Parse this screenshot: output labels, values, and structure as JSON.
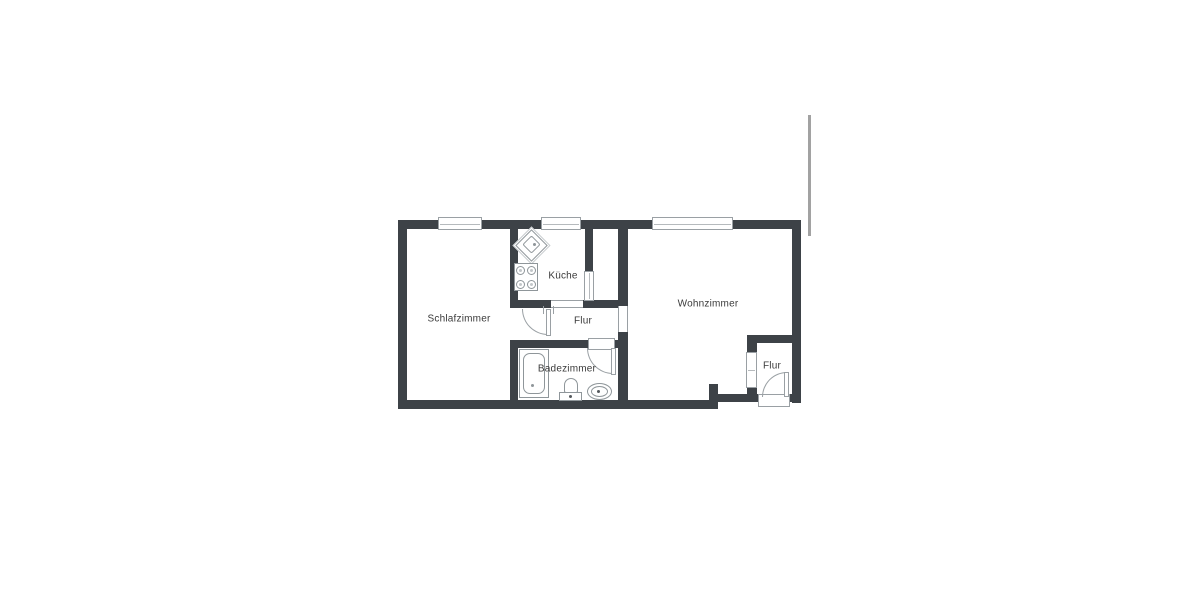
{
  "floorplan": {
    "type": "apartment-floor-plan",
    "wall_color": "#3d4247",
    "symbol_line_color": "#9aa0a4",
    "background_color": "#ffffff",
    "rooms": [
      {
        "id": "schlafzimmer",
        "label": "Schlafzimmer"
      },
      {
        "id": "kueche",
        "label": "Küche"
      },
      {
        "id": "flur",
        "label": "Flur"
      },
      {
        "id": "wohnzimmer",
        "label": "Wohnzimmer"
      },
      {
        "id": "badezimmer",
        "label": "Badezimmer"
      },
      {
        "id": "flur-eingang",
        "label": "Flur"
      }
    ],
    "fixtures": [
      "kitchen-corner-sink",
      "stove-4-burners",
      "bathtub",
      "washbasin",
      "toilet"
    ],
    "openings": {
      "windows": 5,
      "door_arcs": 3,
      "open_passages": 2,
      "entrance_threshold": 1
    }
  }
}
